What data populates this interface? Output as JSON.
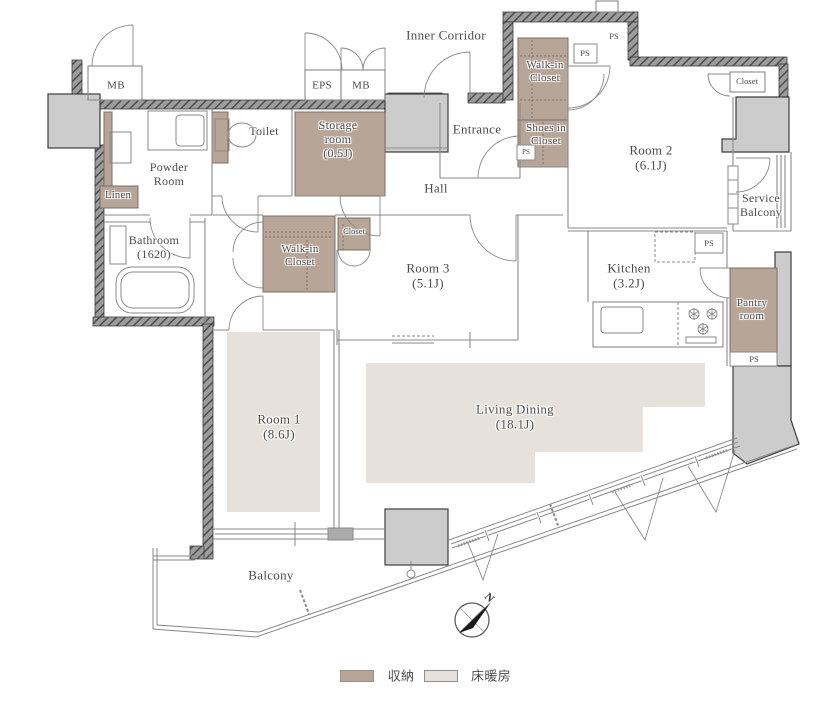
{
  "plan_type": "apartment-floor-plan",
  "rooms": {
    "room1": {
      "name": "Room 1",
      "size": "(8.6J)"
    },
    "room2": {
      "name": "Room 2",
      "size": "(6.1J)"
    },
    "room3": {
      "name": "Room 3",
      "size": "(5.1J)"
    },
    "living_dining": {
      "name": "Living Dining",
      "size": "(18.1J)"
    },
    "kitchen": {
      "name": "Kitchen",
      "size": "(3.2J)"
    },
    "bathroom": {
      "name": "Bathroom",
      "size": "(1620)"
    },
    "storage_room": {
      "name": "Storage room",
      "size": "(0.5J)"
    }
  },
  "labels": {
    "inner_corridor": "Inner Corridor",
    "entrance": "Entrance",
    "hall": "Hall",
    "toilet": "Toilet",
    "powder_room": "Powder Room",
    "linen": "Linen",
    "walk_in_closet": "Walk-in Closet",
    "shoes_in_closet": "Shoes in Closet",
    "closet": "Closet",
    "service_balcony": "Service Balcony",
    "pantry_room": "Pantry room",
    "balcony": "Balcony",
    "mb": "MB",
    "eps": "EPS",
    "ps": "PS"
  },
  "compass": {
    "north": "N"
  },
  "legend": {
    "storage_label": "収納",
    "floor_heating_label": "床暖房"
  },
  "colors": {
    "storage_fill": "#b7a597",
    "floor_heating_fill": "#e6e2db",
    "wall_gray": "#9c9c9c",
    "concrete_gray": "#cccccc"
  }
}
